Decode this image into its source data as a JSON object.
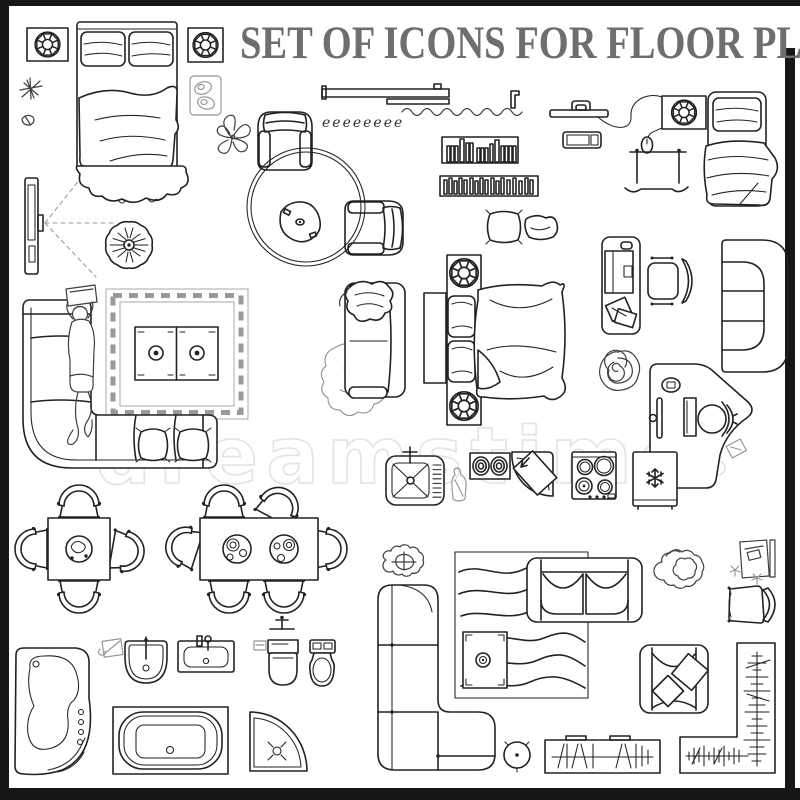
{
  "poster": {
    "title": "SET OF ICONS FOR FLOOR PLAN",
    "watermark": "dreamstime",
    "squiggle": "eeeeeeee",
    "colors": {
      "background": "#ffffff",
      "line": "#222222",
      "sketch": "#949494",
      "title": "#6e6e6e",
      "watermark": "#e3e3e3",
      "wall_frame": "#161616"
    },
    "icons": [
      "nightstand-with-plant-left",
      "double-bed-with-blanket",
      "nightstand-with-plant-right",
      "star-sketch",
      "star-sketch-small",
      "switch-plate-sketch",
      "flower-sketch",
      "wall-shelf",
      "curtain-squiggle",
      "wall-bracket",
      "wall-tv-with-cable",
      "media-remote",
      "nightstand-with-plant-top-right",
      "single-bed",
      "drying-rack-bench",
      "wall-tv-with-viewing-angle",
      "curved-console-table",
      "round-plant-top-view",
      "round-rug",
      "armchair",
      "armchair-rotated",
      "triangular-coffee-table",
      "bookshelf-with-books",
      "bookshelf-dense",
      "cushion-large",
      "cushion-small",
      "office-desk-with-laptop",
      "office-chair",
      "chesterfield-sofa",
      "rose-plant-sketch",
      "reception-desk-with-stool",
      "corner-sofa-with-person",
      "border-rug",
      "cabinet-table-two-doors",
      "loveseat-with-blanket",
      "animal-skin-rug",
      "quilted-headboard",
      "bed-console-with-plants",
      "double-bed-with-duvet",
      "kitchen-sink",
      "bottle-sketch",
      "double-coil-burner",
      "corner-shower-cabin",
      "four-burner-stove",
      "refrigerator",
      "square-dining-table-four-chairs",
      "rectangular-dining-table-six-chairs",
      "corner-jacuzzi-bathtub",
      "soap-sketch",
      "pedestal-sink",
      "vanity-sink",
      "shower-fixture",
      "toilet-square-bowl",
      "toilet-oval-bowl",
      "rectangular-bathtub",
      "corner-shower-tray",
      "plant-bush",
      "modular-corner-sofa",
      "wavy-rug",
      "loveseat-sofa",
      "safe-table",
      "round-stool",
      "tv-stand-hatched",
      "plant-bush-large",
      "table-with-chair-sketch",
      "trapezoid-armchair",
      "armchair-with-cushions",
      "l-shaped-counter-hatched",
      "flower-sketch-small",
      "wall-frame"
    ]
  }
}
